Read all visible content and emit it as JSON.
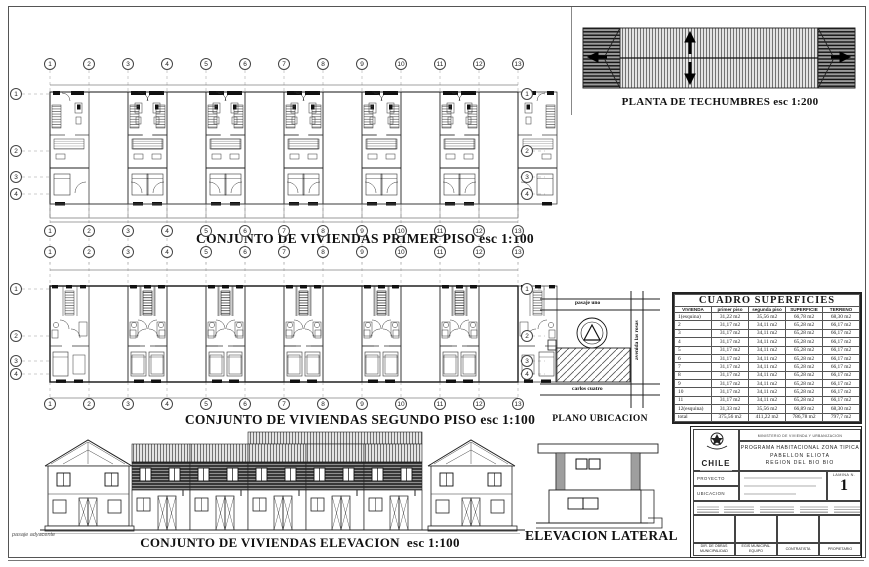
{
  "titles": {
    "primer_piso": "CONJUNTO DE VIVIENDAS PRIMER PISO",
    "primer_scale": "esc 1:100",
    "segundo_piso": "CONJUNTO DE VIVIENDAS SEGUNDO PISO",
    "segundo_scale": "esc 1:100",
    "elevacion": "CONJUNTO DE VIVIENDAS ELEVACION",
    "elevacion_scale": "esc 1:100",
    "techumbres": "PLANTA DE TECHUMBRES",
    "techumbres_scale": "esc 1:200",
    "plano_ubicacion": "PLANO UBICACION",
    "elevacion_lateral": "ELEVACION LATERAL"
  },
  "grid": {
    "columns": [
      "1",
      "2",
      "3",
      "4",
      "5",
      "6",
      "7",
      "8",
      "9",
      "10",
      "11",
      "12",
      "13"
    ],
    "rows": [
      "1",
      "2",
      "3",
      "4"
    ]
  },
  "ubicacion": {
    "street_top": "pasaje uno",
    "street_right": "avenida las rosas",
    "street_bottom": "carlos cuatro"
  },
  "margin_note": "pasaje adyacente",
  "table": {
    "title": "CUADRO  SUPERFICIES",
    "headers": [
      "VIVIENDA",
      "primer piso",
      "segunda piso",
      "SUPERFICIE",
      "TERRENO"
    ],
    "rows": [
      [
        "1(esquina)",
        "31,22 m2",
        "35,56 m2",
        "66,78 m2",
        "68,30 m2"
      ],
      [
        "2",
        "31,17 m2",
        "34,11 m2",
        "65,28 m2",
        "66,17 m2"
      ],
      [
        "3",
        "31,17 m2",
        "34,11 m2",
        "65,28 m2",
        "66,17 m2"
      ],
      [
        "4",
        "31,17 m2",
        "34,11 m2",
        "65,28 m2",
        "66,17 m2"
      ],
      [
        "5",
        "31,17 m2",
        "34,11 m2",
        "65,28 m2",
        "66,17 m2"
      ],
      [
        "6",
        "31,17 m2",
        "34,11 m2",
        "65,28 m2",
        "66,17 m2"
      ],
      [
        "7",
        "31,17 m2",
        "34,11 m2",
        "65,28 m2",
        "66,17 m2"
      ],
      [
        "8",
        "31,17 m2",
        "34,11 m2",
        "65,28 m2",
        "66,17 m2"
      ],
      [
        "9",
        "31,17 m2",
        "34,11 m2",
        "65,28 m2",
        "66,17 m2"
      ],
      [
        "10",
        "31,17 m2",
        "34,11 m2",
        "65,28 m2",
        "66,17 m2"
      ],
      [
        "11",
        "31,17 m2",
        "34,11 m2",
        "65,28 m2",
        "66,17 m2"
      ],
      [
        "12(esquina)",
        "31,33 m2",
        "35,56 m2",
        "66,89 m2",
        "68,30 m2"
      ],
      [
        "total",
        "375,56 m2",
        "411,22 m2",
        "786,78 m2",
        "797,7 m2"
      ]
    ]
  },
  "titleblock": {
    "country": "CHILE",
    "ministry": "MINISTERIO DE VIVIENDA Y URBANIZACION",
    "program_line1": "PROGRAMA   HABITACIONAL   ZONA TIPICA",
    "program_line2": "PABELLON ELIOTA",
    "program_line3": "REGION DEL BIO BIO",
    "proyecto_label": "PROYECTO",
    "ubicacion_label": "UBICACION",
    "lamina_label": "LAMINA N.",
    "lamina_number": "1",
    "sign1": "DIR. DE OBRAS MUNICIPALIDAD",
    "sign2": "EGIS MUNICIPAL EQUIPO",
    "sign3": "CONTRATISTA",
    "sign4": "PROPIETARIO"
  }
}
